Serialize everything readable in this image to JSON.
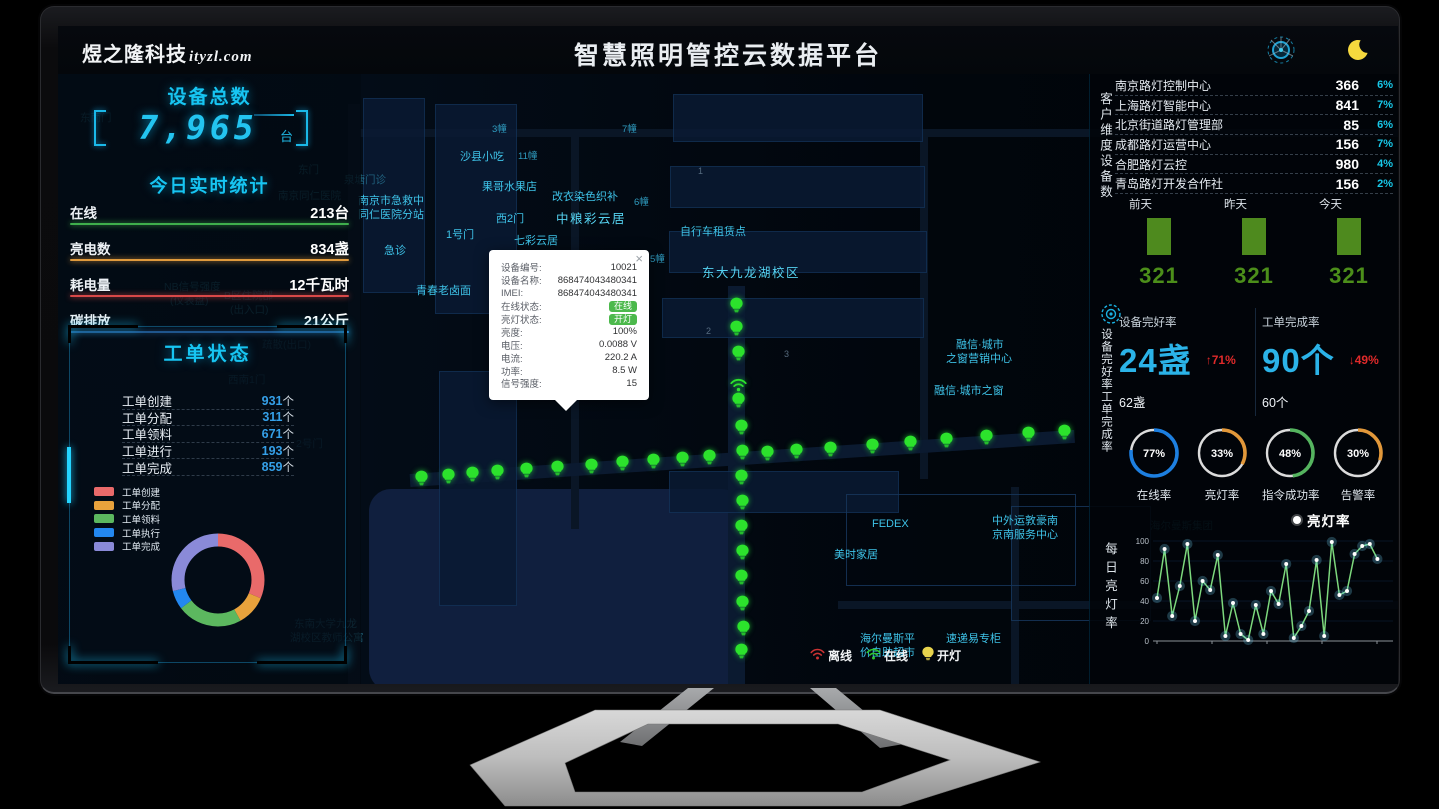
{
  "header": {
    "logo": "煜之隆科技",
    "logo_domain": "ityzl.com",
    "title": "智慧照明管控云数据平台",
    "icons": [
      "radar-decoration-icon",
      "moon-icon"
    ]
  },
  "left_panel": {
    "device_total": {
      "title": "设备总数",
      "value": "7,965",
      "unit": "台"
    },
    "today_stats": {
      "title": "今日实时统计",
      "rows": [
        {
          "label": "在线",
          "value": "213台",
          "color": "#3fae4c"
        },
        {
          "label": "亮电数",
          "value": "834盏",
          "color": "#e09a3c"
        },
        {
          "label": "耗电量",
          "value": "12千瓦时",
          "color": "#d84848"
        },
        {
          "label": "碳排放",
          "value": "21公斤",
          "color": "#2f80d0"
        }
      ]
    },
    "workorders": {
      "title": "工单状态",
      "rows": [
        {
          "label": "工单创建",
          "value": "931",
          "unit": "个"
        },
        {
          "label": "工单分配",
          "value": "311",
          "unit": "个"
        },
        {
          "label": "工单领料",
          "value": "671",
          "unit": "个"
        },
        {
          "label": "工单进行",
          "value": "193",
          "unit": "个"
        },
        {
          "label": "工单完成",
          "value": "859",
          "unit": "个"
        }
      ],
      "legend": [
        {
          "label": "工单创建",
          "color": "#e96a6a"
        },
        {
          "label": "工单分配",
          "color": "#e8a23c"
        },
        {
          "label": "工单领料",
          "color": "#5cb85f"
        },
        {
          "label": "工单执行",
          "color": "#2388f0"
        },
        {
          "label": "工单完成",
          "color": "#8a8ad8"
        }
      ]
    }
  },
  "map": {
    "popup": {
      "close_label": "×",
      "badge_color": "#4cb94c",
      "rows": [
        {
          "label": "设备编号:",
          "value": "10021"
        },
        {
          "label": "设备名称:",
          "value": "868474043480341"
        },
        {
          "label": "IMEI:",
          "value": "868474043480341"
        },
        {
          "label": "在线状态:",
          "value": "在线",
          "badge": true
        },
        {
          "label": "亮灯状态:",
          "value": "开灯",
          "badge": true
        },
        {
          "label": "亮度:",
          "value": "100%"
        },
        {
          "label": "电压:",
          "value": "0.0088 V"
        },
        {
          "label": "电流:",
          "value": "220.2 A"
        },
        {
          "label": "功率:",
          "value": "8.5 W"
        },
        {
          "label": "信号强度:",
          "value": "15"
        }
      ]
    },
    "status_legend": [
      {
        "label": "离线",
        "icon": "wifi-icon",
        "color": "#cc3333"
      },
      {
        "label": "在线",
        "icon": "wifi-icon",
        "color": "#2ec82e"
      },
      {
        "label": "开灯",
        "icon": "bulb-icon",
        "color": "#e8d44d"
      }
    ],
    "lamp_color": "#2ce22c",
    "labels": [
      {
        "t": "泉塘门诊",
        "x": 286,
        "y": 146,
        "c": "dim"
      },
      {
        "t": "南京市急救中",
        "x": 300,
        "y": 166,
        "c": ""
      },
      {
        "t": "同仁医院分站",
        "x": 300,
        "y": 180,
        "c": ""
      },
      {
        "t": "急诊",
        "x": 326,
        "y": 216,
        "c": ""
      },
      {
        "t": "1号门",
        "x": 388,
        "y": 200,
        "c": ""
      },
      {
        "t": "沙县小吃",
        "x": 402,
        "y": 122,
        "c": ""
      },
      {
        "t": "3幢",
        "x": 434,
        "y": 95,
        "c": "sm"
      },
      {
        "t": "11幢",
        "x": 460,
        "y": 122,
        "c": "sm"
      },
      {
        "t": "果哥水果店",
        "x": 424,
        "y": 152,
        "c": ""
      },
      {
        "t": "西2门",
        "x": 438,
        "y": 184,
        "c": ""
      },
      {
        "t": "七彩云居",
        "x": 456,
        "y": 206,
        "c": ""
      },
      {
        "t": "10幢",
        "x": 456,
        "y": 225,
        "c": "sm"
      },
      {
        "t": "青春老卤面",
        "x": 358,
        "y": 256,
        "c": ""
      },
      {
        "t": "改衣染色织补",
        "x": 494,
        "y": 162,
        "c": ""
      },
      {
        "t": "中粮彩云居",
        "x": 498,
        "y": 182,
        "c": "big"
      },
      {
        "t": "7幢",
        "x": 564,
        "y": 95,
        "c": "sm"
      },
      {
        "t": "6幢",
        "x": 576,
        "y": 168,
        "c": "sm"
      },
      {
        "t": "自行车租赁点",
        "x": 622,
        "y": 197,
        "c": ""
      },
      {
        "t": "5幢",
        "x": 592,
        "y": 225,
        "c": "sm"
      },
      {
        "t": "东大九龙湖校区",
        "x": 644,
        "y": 236,
        "c": "big"
      },
      {
        "t": "融信·城市",
        "x": 898,
        "y": 310,
        "c": ""
      },
      {
        "t": "之窗营销中心",
        "x": 888,
        "y": 324,
        "c": ""
      },
      {
        "t": "融信·城市之窗",
        "x": 876,
        "y": 356,
        "c": ""
      },
      {
        "t": "FEDEX",
        "x": 814,
        "y": 492,
        "c": ""
      },
      {
        "t": "美时家居",
        "x": 776,
        "y": 520,
        "c": ""
      },
      {
        "t": "中外运敦豪南",
        "x": 934,
        "y": 486,
        "c": ""
      },
      {
        "t": "京南服务中心",
        "x": 934,
        "y": 500,
        "c": ""
      },
      {
        "t": "海尔曼斯平",
        "x": 802,
        "y": 604,
        "c": ""
      },
      {
        "t": "价自助超市",
        "x": 802,
        "y": 618,
        "c": ""
      },
      {
        "t": "速递易专柜",
        "x": 888,
        "y": 604,
        "c": ""
      },
      {
        "t": "海尔曼斯集团",
        "x": 1092,
        "y": 492,
        "c": "dim"
      },
      {
        "t": "东南大学九龙",
        "x": 236,
        "y": 590,
        "c": "dim"
      },
      {
        "t": "湖校区教师公寓",
        "x": 232,
        "y": 604,
        "c": "dim"
      },
      {
        "t": "东门",
        "x": 240,
        "y": 136,
        "c": "dim"
      },
      {
        "t": "南京同仁医院",
        "x": 220,
        "y": 162,
        "c": "dim"
      },
      {
        "t": "B区住院部",
        "x": 166,
        "y": 262,
        "c": "dim"
      },
      {
        "t": "(出入口)",
        "x": 172,
        "y": 276,
        "c": "dim"
      },
      {
        "t": "NB信号强度",
        "x": 106,
        "y": 253,
        "c": "dim"
      },
      {
        "t": "(仪表盘)",
        "x": 112,
        "y": 267,
        "c": "dim"
      },
      {
        "t": "疏散(出口)",
        "x": 204,
        "y": 311,
        "c": "dim"
      },
      {
        "t": "西南1门",
        "x": 170,
        "y": 346,
        "c": "dim"
      },
      {
        "t": "2号门",
        "x": 238,
        "y": 410,
        "c": "dim"
      },
      {
        "t": "东南门",
        "x": 22,
        "y": 84,
        "c": "dim"
      },
      {
        "t": "2",
        "x": 648,
        "y": 300,
        "c": "num"
      },
      {
        "t": "3",
        "x": 726,
        "y": 323,
        "c": "num"
      },
      {
        "t": "1",
        "x": 640,
        "y": 140,
        "c": "num"
      }
    ],
    "lamps": [
      [
        363,
        458
      ],
      [
        390,
        456
      ],
      [
        414,
        454
      ],
      [
        439,
        452
      ],
      [
        468,
        450
      ],
      [
        499,
        448
      ],
      [
        533,
        446
      ],
      [
        564,
        443
      ],
      [
        595,
        441
      ],
      [
        624,
        439
      ],
      [
        651,
        437
      ],
      [
        709,
        433
      ],
      [
        738,
        431
      ],
      [
        772,
        429
      ],
      [
        814,
        426
      ],
      [
        852,
        423
      ],
      [
        888,
        420
      ],
      [
        928,
        417
      ],
      [
        970,
        414
      ],
      [
        1006,
        412
      ],
      [
        678,
        285
      ],
      [
        678,
        308
      ],
      [
        680,
        333
      ],
      [
        680,
        380
      ],
      [
        683,
        407
      ],
      [
        684,
        432
      ],
      [
        683,
        457
      ],
      [
        684,
        482
      ],
      [
        683,
        507
      ],
      [
        684,
        532
      ],
      [
        683,
        557
      ],
      [
        684,
        583
      ],
      [
        685,
        608
      ],
      [
        683,
        631
      ]
    ],
    "wifi_marker": [
      680,
      358
    ]
  },
  "right_panel": {
    "customers": {
      "side_label": "客户维度设备数",
      "rows": [
        {
          "name": "南京路灯控制中心",
          "value": "366",
          "pct": "6%"
        },
        {
          "name": "上海路灯智能中心",
          "value": "841",
          "pct": "7%"
        },
        {
          "name": "北京街道路灯管理部",
          "value": "85",
          "pct": "6%"
        },
        {
          "name": "成都路灯运营中心",
          "value": "156",
          "pct": "7%"
        },
        {
          "name": "合肥路灯云控",
          "value": "980",
          "pct": "4%"
        },
        {
          "name": "青岛路灯开发合作社",
          "value": "156",
          "pct": "2%"
        }
      ]
    },
    "rates": {
      "side_label": "设备完好率工单完成率",
      "cards": [
        {
          "title": "设备完好率",
          "big": "24盏",
          "trend": "↑71%",
          "sub": "62盏"
        },
        {
          "title": "工单完成率",
          "big": "90个",
          "trend": "↓49%",
          "sub": "60个"
        }
      ]
    },
    "daily_chart": {
      "side_label": "每日亮灯率",
      "legend": "亮灯率"
    }
  },
  "chart_data": [
    {
      "type": "pie",
      "title": "工单状态分布",
      "labels": [
        "工单创建",
        "工单分配",
        "工单领料",
        "工单执行",
        "工单完成"
      ],
      "values": [
        931,
        311,
        671,
        193,
        859
      ],
      "colors": [
        "#e96a6a",
        "#e8a23c",
        "#5cb85f",
        "#2388f0",
        "#8a8ad8"
      ],
      "legend_position": "left"
    },
    {
      "type": "bar",
      "title": "近三日设备数",
      "categories": [
        "前天",
        "昨天",
        "今天"
      ],
      "values": [
        321,
        321,
        321
      ],
      "color": "#4e8a1e",
      "ylim": [
        0,
        400
      ]
    },
    {
      "type": "gauge",
      "items": [
        {
          "label": "在线率",
          "value": 77,
          "color": "#1d7fe0"
        },
        {
          "label": "亮灯率",
          "value": 33,
          "color": "#e2983a"
        },
        {
          "label": "指令成功率",
          "value": 48,
          "color": "#55b45f"
        },
        {
          "label": "告警率",
          "value": 30,
          "color": "#e2983a"
        }
      ]
    },
    {
      "type": "line",
      "title": "每日亮灯率",
      "legend": "亮灯率",
      "ylabel": "每日亮灯率",
      "ylim": [
        0,
        100
      ],
      "yticks": [
        0,
        20,
        40,
        60,
        80,
        100
      ],
      "values": [
        43,
        92,
        25,
        55,
        97,
        20,
        60,
        51,
        86,
        5,
        38,
        7,
        1,
        36,
        7,
        50,
        37,
        77,
        3,
        15,
        30,
        81,
        5,
        99,
        46,
        50,
        87,
        95,
        97,
        82
      ],
      "line_color": "#7dd87d",
      "point_color": "#ffffff",
      "grid": true
    }
  ]
}
